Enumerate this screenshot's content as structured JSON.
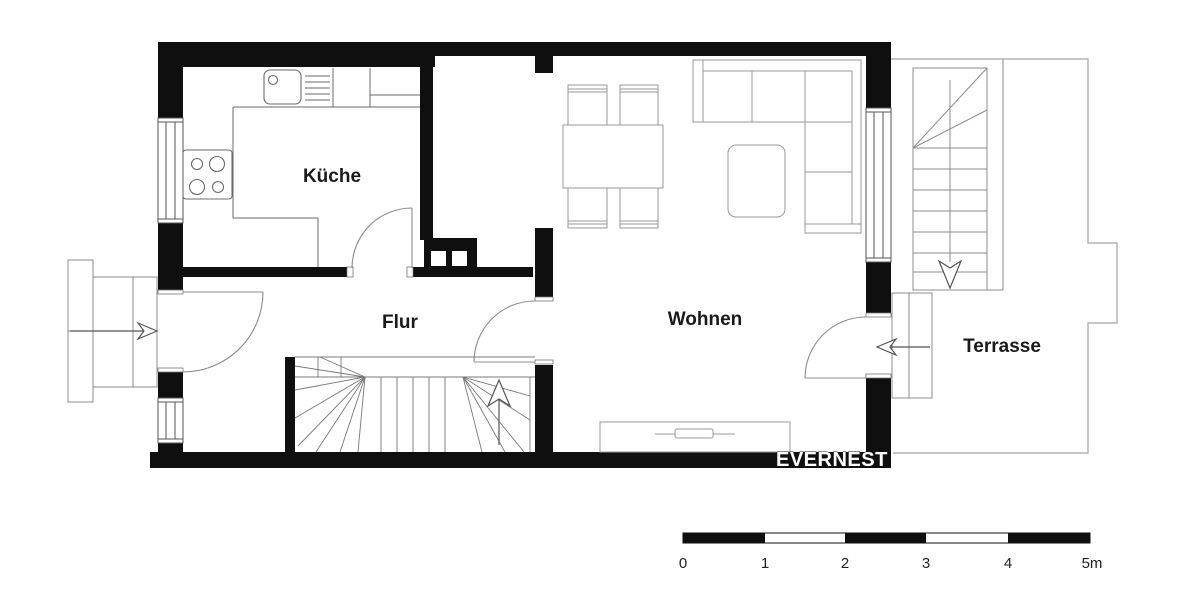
{
  "floorplan": {
    "title": "floor-plan",
    "rooms": [
      {
        "id": "kueche",
        "label": "Küche"
      },
      {
        "id": "flur",
        "label": "Flur"
      },
      {
        "id": "wohnen",
        "label": "Wohnen"
      },
      {
        "id": "terrasse",
        "label": "Terrasse"
      }
    ],
    "watermark": {
      "text": "EVERNEST"
    },
    "scale_bar": {
      "unit_labels": [
        "0",
        "1",
        "2",
        "3",
        "4",
        "5m"
      ]
    },
    "icons": [
      "entrance-arrow-icon",
      "terrace-entry-arrow-icon",
      "stairs-up-arrow-icon",
      "stairs-down-arrow-icon"
    ],
    "colors": {
      "wall": "#0f0f0f",
      "fixture_line": "#6b6b6b",
      "furniture_line": "#9a9a9a",
      "terrace_line": "#a3a3a3",
      "label_text": "#1a1a1a",
      "watermark_fill": "#ffffff",
      "watermark_outline": "#1c1c1c",
      "scale_black": "#0f0f0f",
      "background": "#ffffff"
    }
  }
}
